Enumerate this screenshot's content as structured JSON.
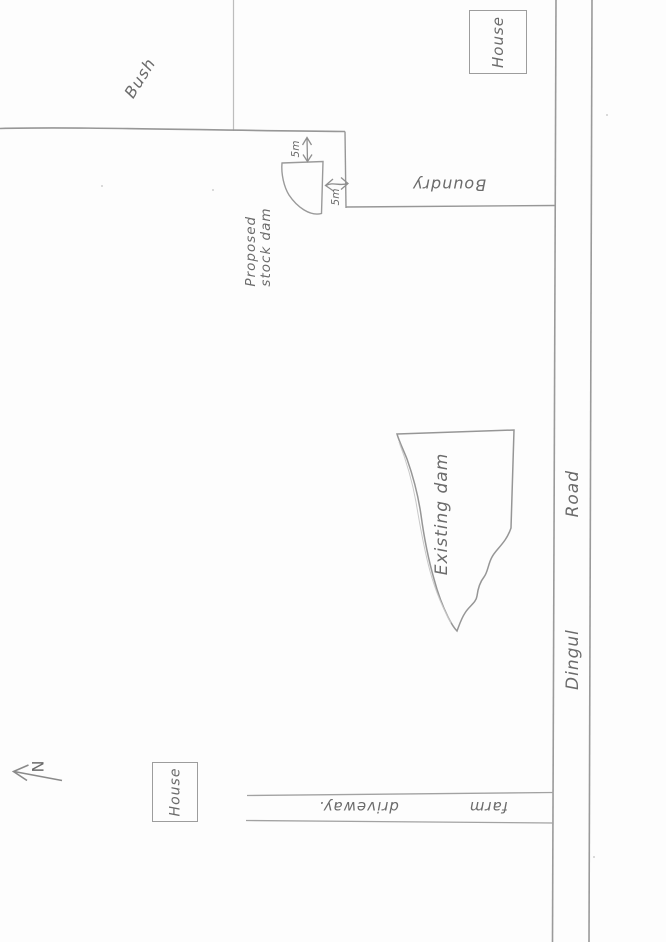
{
  "sketch": {
    "north_marker": {
      "label": "N"
    },
    "bush": {
      "label": "Bush"
    },
    "boundary": {
      "label": "Boundry"
    },
    "houses": {
      "top_right": "House",
      "bottom_left": "House"
    },
    "proposed_dam": {
      "label_lines": [
        "Proposed",
        "stock dam"
      ],
      "setback_top": "5m",
      "setback_side": "5m"
    },
    "existing_dam": {
      "label": "Existing dam"
    },
    "road": {
      "words": [
        "Dingul",
        "Road"
      ]
    },
    "driveway": {
      "words": [
        "farm",
        "driveway."
      ]
    }
  },
  "colors": {
    "paper": "#fdfdfd",
    "pencil": "#979797",
    "pencil_light": "#bdbdbd",
    "handwriting": "#6b6b6b"
  }
}
